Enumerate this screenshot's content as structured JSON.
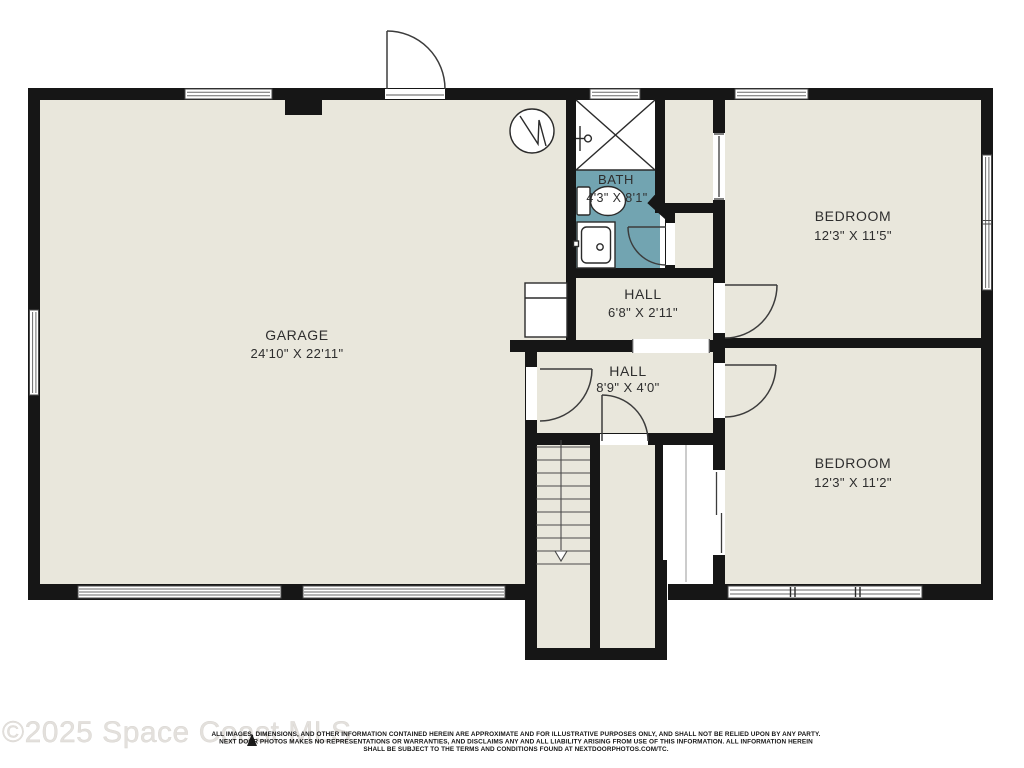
{
  "page": {
    "type": "residential-floor-plan"
  },
  "rooms": {
    "garage": {
      "name": "GARAGE",
      "dims": "24'10\" X 22'11\""
    },
    "bath": {
      "name": "BATH",
      "dims": "4'3\" X 8'1\""
    },
    "hall1": {
      "name": "HALL",
      "dims": "6'8\" X 2'11\""
    },
    "hall2": {
      "name": "HALL",
      "dims": "8'9\" X 4'0\""
    },
    "bedroom1": {
      "name": "BEDROOM",
      "dims": "12'3\" X 11'5\""
    },
    "bedroom2": {
      "name": "BEDROOM",
      "dims": "12'3\" X 11'2\""
    }
  },
  "footer": {
    "watermark": "©2025 Space Coast MLS",
    "disclaimer_line1": "ALL IMAGES, DIMENSIONS, AND OTHER INFORMATION CONTAINED HEREIN ARE APPROXIMATE AND FOR ILLUSTRATIVE PURPOSES ONLY, AND SHALL NOT BE RELIED UPON BY ANY PARTY.",
    "disclaimer_line2": "NEXT DOOR PHOTOS MAKES NO REPRESENTATIONS OR WARRANTIES, AND DISCLAIMS ANY AND ALL LIABILITY ARISING FROM USE OF THIS INFORMATION. ALL INFORMATION HEREIN",
    "disclaimer_line3": "SHALL BE SUBJECT TO THE TERMS AND CONDITIONS FOUND AT NEXTDOORPHOTOS.COM/TC."
  },
  "colors": {
    "wall": "#161616",
    "room_fill": "#e9e7dc",
    "bath_fill": "#72a4b1",
    "background": "#ffffff",
    "watermark_text": "#e3e0dc"
  }
}
